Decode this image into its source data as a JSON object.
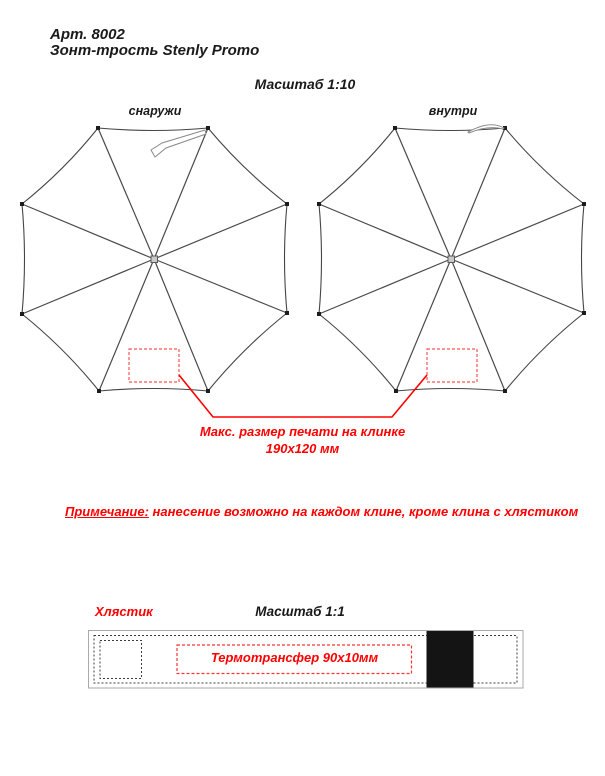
{
  "page": {
    "title_line1": "Арт. 8002",
    "title_line2": "Зонт-трость Stenly Promo"
  },
  "umbrellas": {
    "scale_label": "Масштаб 1:10",
    "left_label": "снаружи",
    "right_label": "внутри",
    "print_note_line1": "Макс. размер печати на клинке",
    "print_note_line2": "190х120 мм"
  },
  "note": {
    "label": "Примечание:",
    "text": "нанесение возможно на каждом клине, кроме клина с хлястиком"
  },
  "strap": {
    "label": "Хлястик",
    "scale_label": "Масштаб 1:1",
    "transfer_label": "Термотрансфер 90х10мм"
  },
  "colors": {
    "accent_red": "#ff0000",
    "dashed_red": "#ff5555",
    "line_dark": "#454545",
    "strap_black": "#141414"
  }
}
